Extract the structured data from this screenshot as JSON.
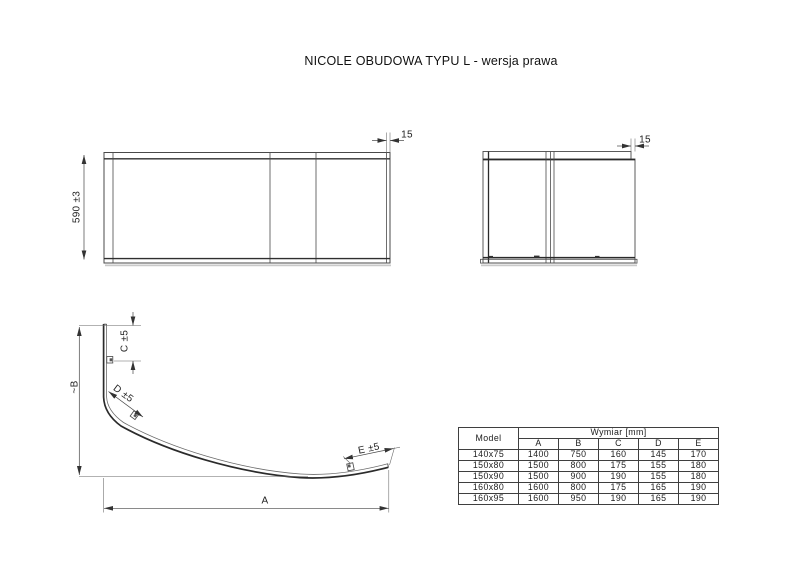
{
  "title": "NICOLE OBUDOWA TYPU L - wersja prawa",
  "front_view": {
    "height_dim": "590 ±3",
    "flange_dim": "15"
  },
  "side_view": {
    "flange_dim": "15"
  },
  "profile_view": {
    "dim_a": "A",
    "dim_b": "~B",
    "dim_c": "C ±5",
    "dim_d": "D ±5",
    "dim_e": "E ±5"
  },
  "table": {
    "model_header": "Model",
    "group_header": "Wymiar [mm]",
    "columns": [
      "A",
      "B",
      "C",
      "D",
      "E"
    ],
    "rows": [
      {
        "model": "140x75",
        "values": [
          "1400",
          "750",
          "160",
          "145",
          "170"
        ]
      },
      {
        "model": "150x80",
        "values": [
          "1500",
          "800",
          "175",
          "155",
          "180"
        ]
      },
      {
        "model": "150x90",
        "values": [
          "1500",
          "900",
          "190",
          "155",
          "180"
        ]
      },
      {
        "model": "160x80",
        "values": [
          "1600",
          "800",
          "175",
          "165",
          "190"
        ]
      },
      {
        "model": "160x95",
        "values": [
          "1600",
          "950",
          "190",
          "165",
          "190"
        ]
      }
    ]
  }
}
